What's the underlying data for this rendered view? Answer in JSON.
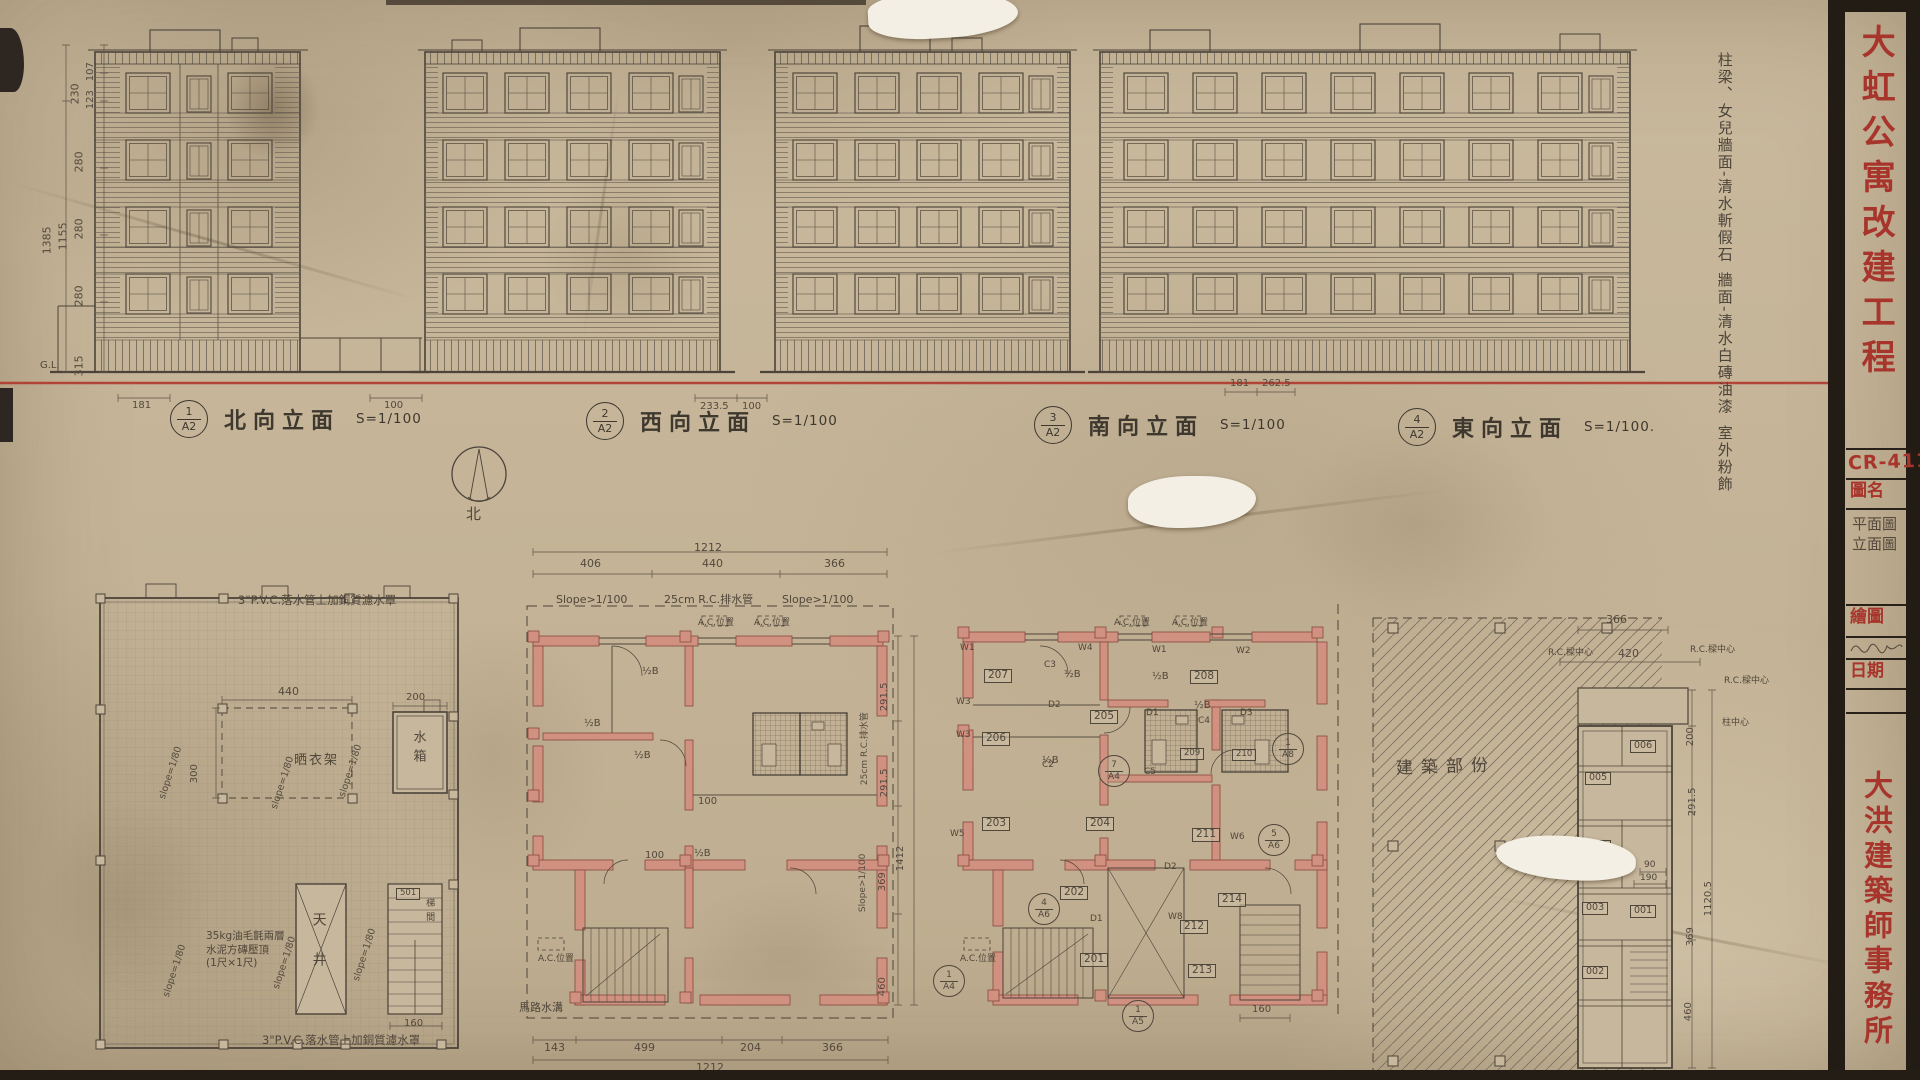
{
  "sheet": {
    "project_title": "大虹公寓改建工程",
    "drawing_no": "CR-411",
    "fields": {
      "drawing_name_label": "圖名",
      "drawing_name_line1": "平面圖",
      "drawing_name_line2": "立面圖",
      "drawn_by_label": "繪圖",
      "date_label": "日期"
    },
    "firm": "大洪建築師事務所"
  },
  "elevations": {
    "finish_notes": {
      "line1": "柱梁、女兒牆面-清水斬假石",
      "line2": "牆面-清水白磚油漆",
      "line3": "室外粉飾"
    },
    "items": [
      {
        "no": "1",
        "sheet": "A2",
        "title": "北向立面",
        "scale": "S=1/100"
      },
      {
        "no": "2",
        "sheet": "A2",
        "title": "西向立面",
        "scale": "S=1/100"
      },
      {
        "no": "3",
        "sheet": "A2",
        "title": "南向立面",
        "scale": "S=1/100"
      },
      {
        "no": "4",
        "sheet": "A2",
        "title": "東向立面",
        "scale": "S=1/100."
      }
    ],
    "left_dims": {
      "sub": [
        "107",
        "123"
      ],
      "segments": [
        "230",
        "280",
        "280",
        "280",
        "315"
      ],
      "totals": [
        "1155",
        "1385"
      ]
    },
    "base_dims": [
      "181",
      "100",
      "233.5",
      "100",
      "181",
      "262.5"
    ],
    "ground_label": "G.L."
  },
  "plans": {
    "compass_label": "北",
    "half_brick": "½B",
    "ac_label": "A.C.位置",
    "dim_100": "100",
    "roof_plan": {
      "pipe_note": "3\"P.V.C.落水管上加銅質濾水罩",
      "coping_note_line1": "35kg油毛氈兩層",
      "coping_note_line2": "水泥方磚壓頂",
      "coping_note_line3": "(1尺×1尺)",
      "water_tank": "水箱",
      "drying_rack": "晒衣架",
      "lightwell": "天井",
      "stair": "梯間",
      "room": "501",
      "slope": "slope=1/80",
      "dims": {
        "rack_width": "440",
        "tank_width": "200",
        "rack_depth": "300",
        "stair_width": "160"
      }
    },
    "plan_b": {
      "top_total": "1212",
      "top_dims": [
        "406",
        "440",
        "366"
      ],
      "bottom_dims": [
        "143",
        "499",
        "204",
        "366"
      ],
      "bottom_total": "1212",
      "right_dims": [
        "291.5",
        "291.5",
        "369",
        "460"
      ],
      "right_total": "1412",
      "slope_note": "Slope>1/100",
      "drain_note": "25cm R.C.排水管",
      "gutter_note": "馬路水溝"
    },
    "plan_c": {
      "rooms": [
        "201",
        "202",
        "203",
        "204",
        "205",
        "206",
        "207",
        "208",
        "209",
        "210",
        "211",
        "212",
        "213",
        "214"
      ],
      "windows": [
        "W1",
        "W2",
        "W3",
        "W4",
        "W5",
        "W6",
        "W8"
      ],
      "doors": [
        "D1",
        "D2",
        "D3"
      ],
      "columns": [
        "C2",
        "C3",
        "C4",
        "C5"
      ],
      "markers": [
        {
          "top": "7",
          "bottom": "A4"
        },
        {
          "top": "1",
          "bottom": "A4"
        },
        {
          "top": "1",
          "bottom": "A8"
        },
        {
          "top": "1",
          "bottom": "A5"
        },
        {
          "top": "4",
          "bottom": "A6"
        },
        {
          "top": "5",
          "bottom": "A6"
        }
      ],
      "stair_dim": "160"
    },
    "plan_d": {
      "area_label": "建築部份",
      "rooms": [
        "006",
        "005",
        "004",
        "003",
        "001",
        "002"
      ],
      "beam_note": "R.C.樑中心",
      "col_note": "柱中心",
      "dims": {
        "w1": "366",
        "w2": "420",
        "d1": "200",
        "d2": "291.5",
        "d3": "369",
        "d4": "460",
        "total": "1120.5",
        "s1": "90",
        "s2": "190"
      }
    }
  }
}
